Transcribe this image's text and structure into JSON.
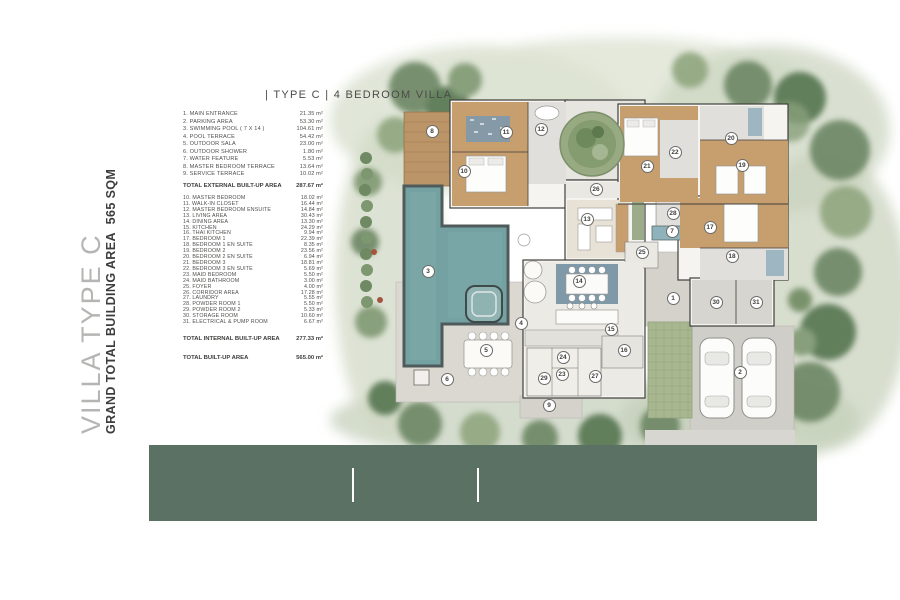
{
  "page": {
    "title": "| TYPE C | 4 BEDROOM VILLA"
  },
  "sidebar": {
    "villa_type": "VILLA TYPE C",
    "grand_total": "GRAND TOTAL BUILDING AREA  565 SQM"
  },
  "legend": {
    "external_items": [
      {
        "n": "1",
        "label": "MAIN ENTRANCE",
        "area": "21.35 m²"
      },
      {
        "n": "2",
        "label": "PARKING  AREA",
        "area": "53.30 m²"
      },
      {
        "n": "3",
        "label": "SWIMMING POOL ( 7 X 14 )",
        "area": "104.61 m²"
      },
      {
        "n": "4",
        "label": "POOL TERRACE",
        "area": "54.42 m²"
      },
      {
        "n": "5",
        "label": "OUTDOOR SALA",
        "area": "23.00 m²"
      },
      {
        "n": "6",
        "label": "OUTDOOR SHOWER",
        "area": "1.80 m²"
      },
      {
        "n": "7",
        "label": "WATER FEATURE",
        "area": "5.53 m²"
      },
      {
        "n": "8",
        "label": "MASTER BEDROOM TERRACE",
        "area": "13.64 m²"
      },
      {
        "n": "9",
        "label": "SERVICE TERRACE",
        "area": "10.02 m²"
      }
    ],
    "external_total": {
      "label": "TOTAL EXTERNAL BUILT-UP AREA",
      "area": "287.67 m²"
    },
    "internal_items": [
      {
        "n": "10",
        "label": "MASTER BEDROOM",
        "area": "18.02 m²"
      },
      {
        "n": "11",
        "label": "WALK-IN CLOSET",
        "area": "16.44 m²"
      },
      {
        "n": "12",
        "label": "MASTER BEDROOM ENSUITE",
        "area": "14.84 m²"
      },
      {
        "n": "13",
        "label": "LIVING AREA",
        "area": "30.43 m²"
      },
      {
        "n": "14",
        "label": "DINING AREA",
        "area": "13.30 m²"
      },
      {
        "n": "15",
        "label": "KITCHEN",
        "area": "24.29 m²"
      },
      {
        "n": "16",
        "label": "THAI KITCHEN",
        "area": "9.94 m²"
      },
      {
        "n": "17",
        "label": "BEDROOM 1",
        "area": "22.39 m²"
      },
      {
        "n": "18",
        "label": "BEDROOM 1 EN SUITE",
        "area": "8.35 m²"
      },
      {
        "n": "19",
        "label": "BEDROOM 2",
        "area": "23.56 m²"
      },
      {
        "n": "20",
        "label": "BEDROOM 2 EN SUITE",
        "area": "6.94 m²"
      },
      {
        "n": "21",
        "label": "BEDROOM 3",
        "area": "18.81 m²"
      },
      {
        "n": "22",
        "label": "BEDROOM 3 EN SUITE",
        "area": "5.69 m²"
      },
      {
        "n": "23",
        "label": "MAID BEDROOM",
        "area": "5.50 m²"
      },
      {
        "n": "24",
        "label": "MAID BATHROOM",
        "area": "3.00 m²"
      },
      {
        "n": "25",
        "label": "FOYER",
        "area": "4.00 m²"
      },
      {
        "n": "26",
        "label": "CORRIDOR AREA",
        "area": "17.28 m²"
      },
      {
        "n": "27",
        "label": "LAUNDRY",
        "area": "5.55 m²"
      },
      {
        "n": "28",
        "label": "POWDER ROOM 1",
        "area": "5.50 m²"
      },
      {
        "n": "29",
        "label": "POWDER ROOM 2",
        "area": "5.33 m²"
      },
      {
        "n": "30",
        "label": "STORAGE ROOM",
        "area": "10.60 m²"
      },
      {
        "n": "31",
        "label": "ELECTRICAL & PUMP ROOM",
        "area": "6.67 m²"
      }
    ],
    "internal_total": {
      "label": "TOTAL INTERNAL  BUILT-UP AREA",
      "area": "277.33 m²"
    },
    "grand_total": {
      "label": "TOTAL BUILT-UP AREA",
      "area": "565.00 m²"
    }
  },
  "plan": {
    "markers": [
      {
        "n": 1,
        "x": 673,
        "y": 298
      },
      {
        "n": 2,
        "x": 740,
        "y": 372
      },
      {
        "n": 3,
        "x": 428,
        "y": 271
      },
      {
        "n": 4,
        "x": 521,
        "y": 323
      },
      {
        "n": 5,
        "x": 486,
        "y": 350
      },
      {
        "n": 6,
        "x": 447,
        "y": 379
      },
      {
        "n": 7,
        "x": 672,
        "y": 231
      },
      {
        "n": 8,
        "x": 432,
        "y": 131
      },
      {
        "n": 9,
        "x": 549,
        "y": 405
      },
      {
        "n": 10,
        "x": 464,
        "y": 171
      },
      {
        "n": 11,
        "x": 506,
        "y": 132
      },
      {
        "n": 12,
        "x": 541,
        "y": 129
      },
      {
        "n": 13,
        "x": 587,
        "y": 219
      },
      {
        "n": 14,
        "x": 579,
        "y": 281
      },
      {
        "n": 15,
        "x": 611,
        "y": 329
      },
      {
        "n": 16,
        "x": 624,
        "y": 350
      },
      {
        "n": 17,
        "x": 710,
        "y": 227
      },
      {
        "n": 18,
        "x": 732,
        "y": 256
      },
      {
        "n": 19,
        "x": 742,
        "y": 165
      },
      {
        "n": 20,
        "x": 731,
        "y": 138
      },
      {
        "n": 21,
        "x": 647,
        "y": 166
      },
      {
        "n": 22,
        "x": 675,
        "y": 152
      },
      {
        "n": 23,
        "x": 562,
        "y": 374
      },
      {
        "n": 24,
        "x": 563,
        "y": 357
      },
      {
        "n": 25,
        "x": 642,
        "y": 252
      },
      {
        "n": 26,
        "x": 596,
        "y": 189
      },
      {
        "n": 27,
        "x": 595,
        "y": 376
      },
      {
        "n": 28,
        "x": 673,
        "y": 213
      },
      {
        "n": 29,
        "x": 544,
        "y": 378
      },
      {
        "n": 30,
        "x": 716,
        "y": 302
      },
      {
        "n": 31,
        "x": 756,
        "y": 302
      }
    ]
  },
  "colors": {
    "footer_green": "#5a7164",
    "pool_teal": "#74a1a1",
    "wood_floor": "#c79e6e",
    "foliage": "#7f9872"
  }
}
